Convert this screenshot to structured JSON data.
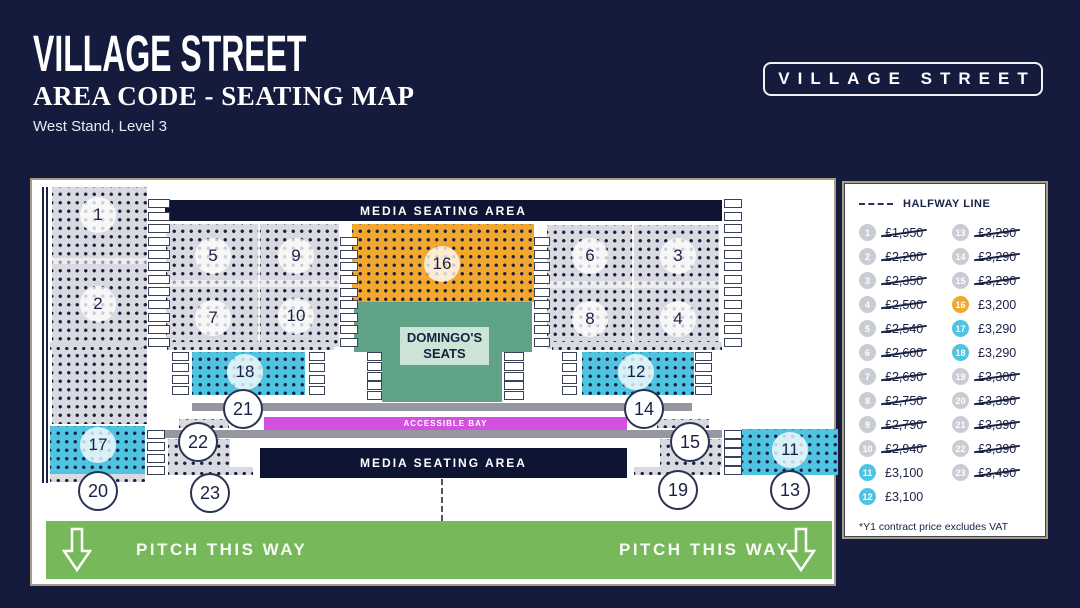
{
  "header": {
    "title": "VILLAGE STREET",
    "subtitle": "AREA CODE - SEATING MAP",
    "location": "West Stand, Level 3",
    "badge": "VILLAGE STREET"
  },
  "map": {
    "media_seating_top": "MEDIA SEATING AREA",
    "media_seating_bottom": "MEDIA SEATING AREA",
    "domingos_line1": "DOMINGO'S",
    "domingos_line2": "SEATS",
    "accessible_bay": "ACCESSIBLE BAY",
    "pitch_left": "PITCH THIS WAY",
    "pitch_right": "PITCH THIS WAY",
    "section_numbers": [
      "1",
      "2",
      "3",
      "4",
      "5",
      "6",
      "7",
      "8",
      "9",
      "10",
      "11",
      "12",
      "13",
      "14",
      "15",
      "16",
      "17",
      "18",
      "19",
      "20",
      "21",
      "22",
      "23"
    ]
  },
  "legend": {
    "halfway_label": "HALFWAY LINE",
    "note": "*Y1 contract price excludes VAT",
    "items": [
      {
        "section": "1",
        "price": "£1,950",
        "sold": true,
        "color": "gray"
      },
      {
        "section": "2",
        "price": "£2,200",
        "sold": true,
        "color": "gray"
      },
      {
        "section": "3",
        "price": "£2,350",
        "sold": true,
        "color": "gray"
      },
      {
        "section": "4",
        "price": "£2,500",
        "sold": true,
        "color": "gray"
      },
      {
        "section": "5",
        "price": "£2,540",
        "sold": true,
        "color": "gray"
      },
      {
        "section": "6",
        "price": "£2,600",
        "sold": true,
        "color": "gray"
      },
      {
        "section": "7",
        "price": "£2,690",
        "sold": true,
        "color": "gray"
      },
      {
        "section": "8",
        "price": "£2,750",
        "sold": true,
        "color": "gray"
      },
      {
        "section": "9",
        "price": "£2,790",
        "sold": true,
        "color": "gray"
      },
      {
        "section": "10",
        "price": "£2,940",
        "sold": true,
        "color": "gray"
      },
      {
        "section": "11",
        "price": "£3,100",
        "sold": false,
        "color": "cyan"
      },
      {
        "section": "12",
        "price": "£3,100",
        "sold": false,
        "color": "cyan"
      },
      {
        "section": "13",
        "price": "£3,290",
        "sold": true,
        "color": "gray"
      },
      {
        "section": "14",
        "price": "£3,290",
        "sold": true,
        "color": "gray"
      },
      {
        "section": "15",
        "price": "£3,290",
        "sold": true,
        "color": "gray"
      },
      {
        "section": "16",
        "price": "£3,200",
        "sold": false,
        "color": "orange"
      },
      {
        "section": "17",
        "price": "£3,290",
        "sold": false,
        "color": "cyan"
      },
      {
        "section": "18",
        "price": "£3,290",
        "sold": false,
        "color": "cyan"
      },
      {
        "section": "19",
        "price": "£3,300",
        "sold": true,
        "color": "gray"
      },
      {
        "section": "20",
        "price": "£3,390",
        "sold": true,
        "color": "gray"
      },
      {
        "section": "21",
        "price": "£3,390",
        "sold": true,
        "color": "gray"
      },
      {
        "section": "22",
        "price": "£3,390",
        "sold": true,
        "color": "gray"
      },
      {
        "section": "23",
        "price": "£3,490",
        "sold": true,
        "color": "gray"
      }
    ]
  },
  "colors": {
    "background": "#141B3C",
    "banner_navy": "#0E1434",
    "seat_gray": "#D9DADF",
    "seat_cyan": "#4FC4E1",
    "seat_orange": "#F2A72E",
    "domingo_green": "#5FA287",
    "domingo_label_bg": "#CCE3D7",
    "accessible_magenta": "#D54FE0",
    "pitch_green": "#76B85A",
    "walkway_gray": "#9598A0"
  }
}
